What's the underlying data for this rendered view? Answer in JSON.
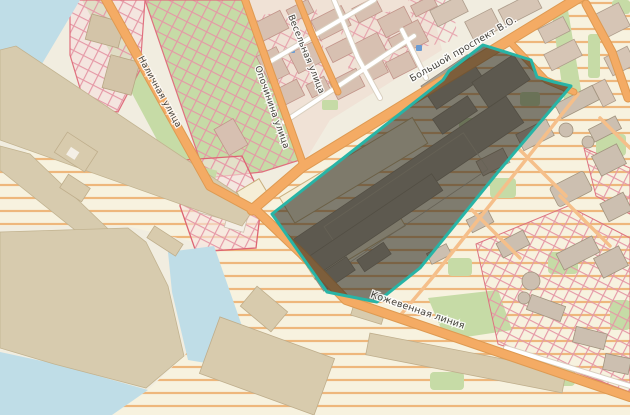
{
  "app": {
    "name": "map-viewer"
  },
  "map": {
    "street_labels": [
      {
        "id": "bolshoy-prospekt",
        "text": "Большой проспект В.О."
      },
      {
        "id": "kozhevennaya-liniya",
        "text": "Кожевенная линия"
      },
      {
        "id": "nalichnaya-ulitsa",
        "text": "Наличная улица"
      },
      {
        "id": "opochinina-ulitsa",
        "text": "Опочинина улица"
      },
      {
        "id": "veselnaya-ulitsa",
        "text": "Весельная улица"
      }
    ],
    "selection": {
      "name": "highlighted-parcel",
      "border_color": "#28b4a6",
      "fill_color": "rgba(40,38,30,0.58)"
    },
    "colors": {
      "base_land": "#f1ede0",
      "water": "#bfdde7",
      "pier_land": "#d7cbae",
      "green": "#c6dba6",
      "road_primary": "#f4ab64",
      "road_minor": "#ffffff",
      "industrial_hatch_line": "#eeb77c",
      "construction_hatch_line": "#e598a6",
      "building": "#d7c0b1",
      "poi_marker": "#6b9bd2"
    }
  }
}
